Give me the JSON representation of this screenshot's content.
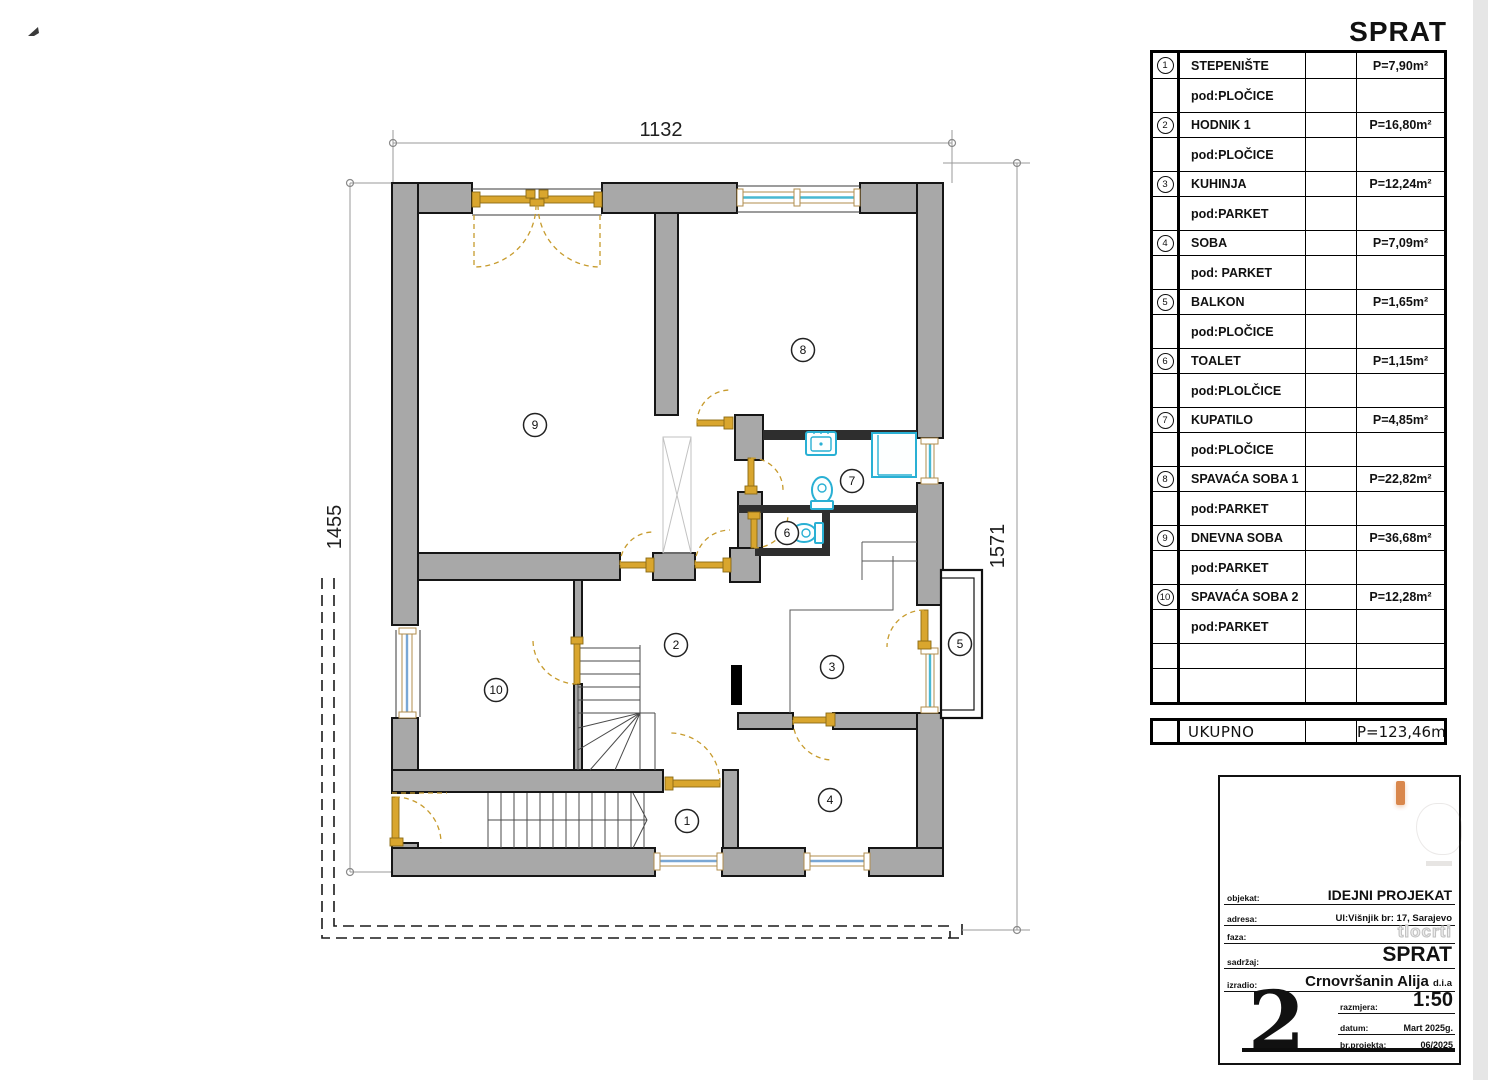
{
  "page": {
    "sheet_title": "SPRAT"
  },
  "dimensions": {
    "top": "1132",
    "left": "1455",
    "right": "1571"
  },
  "legend": {
    "rooms": [
      {
        "num": "1",
        "name": "STEPENIŠTE",
        "area": "P=7,90m²",
        "floor": "pod:PLOČICE"
      },
      {
        "num": "2",
        "name": "HODNIK 1",
        "area": "P=16,80m²",
        "floor": "pod:PLOČICE"
      },
      {
        "num": "3",
        "name": "KUHINJA",
        "area": "P=12,24m²",
        "floor": "pod:PARKET"
      },
      {
        "num": "4",
        "name": "SOBA",
        "area": "P=7,09m²",
        "floor": "pod: PARKET"
      },
      {
        "num": "5",
        "name": "BALKON",
        "area": "P=1,65m²",
        "floor": "pod:PLOČICE"
      },
      {
        "num": "6",
        "name": "TOALET",
        "area": "P=1,15m²",
        "floor": "pod:PLOLČICE"
      },
      {
        "num": "7",
        "name": "KUPATILO",
        "area": "P=4,85m²",
        "floor": "pod:PLOČICE"
      },
      {
        "num": "8",
        "name": "SPAVAĆA SOBA 1",
        "area": "P=22,82m²",
        "floor": "pod:PARKET"
      },
      {
        "num": "9",
        "name": "DNEVNA SOBA",
        "area": "P=36,68m²",
        "floor": "pod:PARKET"
      },
      {
        "num": "10",
        "name": "SPAVAĆA SOBA 2",
        "area": "P=12,28m²",
        "floor": "pod:PARKET"
      }
    ],
    "empty_rows": 2,
    "total": {
      "label": "UKUPNO",
      "area": "P=123,46m²"
    }
  },
  "titleblock": {
    "objekat_label": "objekat:",
    "objekat": "IDEJNI PROJEKAT",
    "adresa_label": "adresa:",
    "adresa": "Ul:Višnjik br: 17, Sarajevo",
    "faza_label": "faza:",
    "faza": "tlocrti",
    "sadrzaj_label": "sadržaj:",
    "sadrzaj": "SPRAT",
    "izradio_label": "izradio:",
    "izradio": "Crnovršanin Alija",
    "izradio_suffix": "d.i.a",
    "razmjera_label": "razmjera:",
    "razmjera": "1:50",
    "datum_label": "datum:",
    "datum": "Mart 2025g.",
    "br_projekta_label": "br.projekta:",
    "br_projekta": "06/2025",
    "sheet_number": "2"
  },
  "colors": {
    "wall": "#a8a8a8",
    "door": "#d9a62e",
    "fixture": "#29b0d4",
    "glazing": "#49b8d2"
  }
}
